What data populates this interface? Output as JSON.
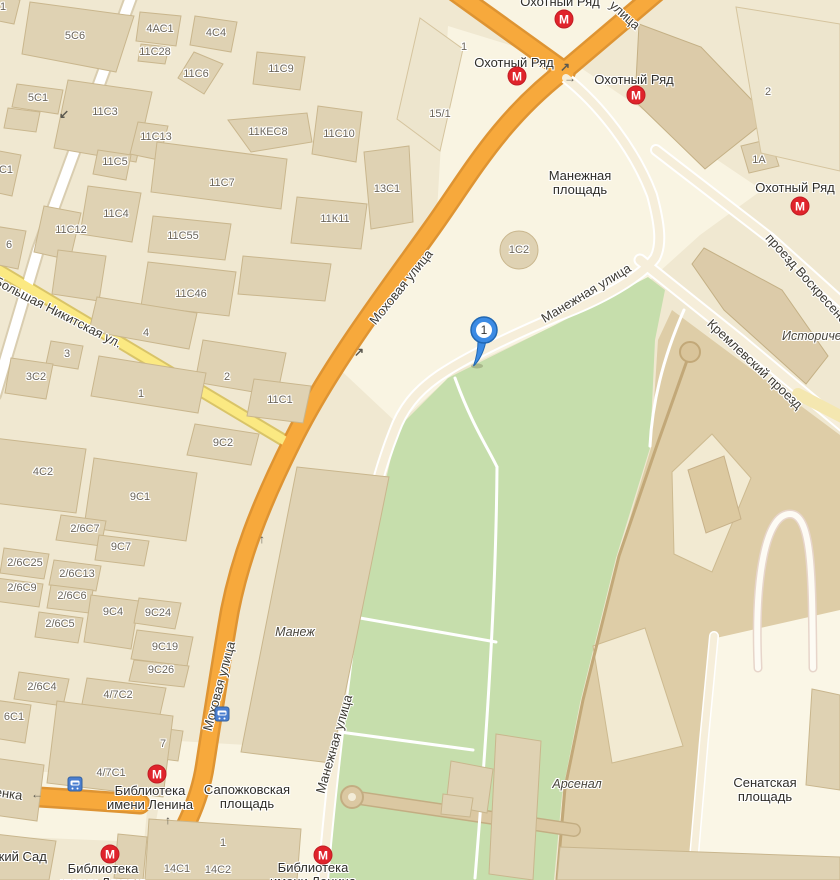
{
  "map": {
    "marker": {
      "label": "1"
    },
    "metro_letter": "М",
    "building_labels": [
      {
        "t": "1",
        "x": 3,
        "y": 7
      },
      {
        "t": "5С6",
        "x": 75,
        "y": 36
      },
      {
        "t": "4АС1",
        "x": 160,
        "y": 29
      },
      {
        "t": "4С4",
        "x": 216,
        "y": 33
      },
      {
        "t": "11С28",
        "x": 155,
        "y": 52
      },
      {
        "t": "11С6",
        "x": 196,
        "y": 74
      },
      {
        "t": "11С9",
        "x": 281,
        "y": 69
      },
      {
        "t": "5С1",
        "x": 38,
        "y": 98
      },
      {
        "t": "11С3",
        "x": 105,
        "y": 112
      },
      {
        "t": "11С13",
        "x": 156,
        "y": 137
      },
      {
        "t": "11КЕС8",
        "x": 268,
        "y": 132
      },
      {
        "t": "11С10",
        "x": 339,
        "y": 134
      },
      {
        "t": "11С5",
        "x": 115,
        "y": 162
      },
      {
        "t": "11С7",
        "x": 222,
        "y": 183
      },
      {
        "t": "13С1",
        "x": 387,
        "y": 189
      },
      {
        "t": "11С4",
        "x": 116,
        "y": 214
      },
      {
        "t": "11К11",
        "x": 335,
        "y": 219
      },
      {
        "t": "11С12",
        "x": 71,
        "y": 230
      },
      {
        "t": "11С55",
        "x": 183,
        "y": 236
      },
      {
        "t": "С1",
        "x": 6,
        "y": 170
      },
      {
        "t": "6",
        "x": 9,
        "y": 245
      },
      {
        "t": "11С46",
        "x": 191,
        "y": 294
      },
      {
        "t": "4",
        "x": 146,
        "y": 333
      },
      {
        "t": "1",
        "x": 464,
        "y": 47
      },
      {
        "t": "15/1",
        "x": 440,
        "y": 114
      },
      {
        "t": "1С2",
        "x": 519,
        "y": 250
      },
      {
        "t": "3",
        "x": 67,
        "y": 354
      },
      {
        "t": "3С2",
        "x": 36,
        "y": 377
      },
      {
        "t": "2",
        "x": 227,
        "y": 377
      },
      {
        "t": "1",
        "x": 141,
        "y": 394
      },
      {
        "t": "11С1",
        "x": 280,
        "y": 400
      },
      {
        "t": "9С2",
        "x": 223,
        "y": 443
      },
      {
        "t": "2",
        "x": 768,
        "y": 92
      },
      {
        "t": "1А",
        "x": 759,
        "y": 160
      },
      {
        "t": "4С2",
        "x": 43,
        "y": 472
      },
      {
        "t": "9С1",
        "x": 140,
        "y": 497
      },
      {
        "t": "2/6С7",
        "x": 85,
        "y": 529
      },
      {
        "t": "9С7",
        "x": 121,
        "y": 547
      },
      {
        "t": "2/6С25",
        "x": 25,
        "y": 563
      },
      {
        "t": "2/6С13",
        "x": 77,
        "y": 574
      },
      {
        "t": "2/6С9",
        "x": 22,
        "y": 588
      },
      {
        "t": "2/6С6",
        "x": 72,
        "y": 596
      },
      {
        "t": "9С4",
        "x": 113,
        "y": 612
      },
      {
        "t": "9С24",
        "x": 158,
        "y": 613
      },
      {
        "t": "2/6С5",
        "x": 60,
        "y": 624
      },
      {
        "t": "9С19",
        "x": 165,
        "y": 647
      },
      {
        "t": "9С26",
        "x": 161,
        "y": 670
      },
      {
        "t": "2/6С4",
        "x": 42,
        "y": 687
      },
      {
        "t": "4/7С2",
        "x": 118,
        "y": 695
      },
      {
        "t": "6С1",
        "x": 14,
        "y": 717
      },
      {
        "t": "7",
        "x": 163,
        "y": 744
      },
      {
        "t": "4/7С1",
        "x": 111,
        "y": 773
      },
      {
        "t": "1",
        "x": 223,
        "y": 843
      },
      {
        "t": "14С1",
        "x": 177,
        "y": 869
      },
      {
        "t": "14С2",
        "x": 218,
        "y": 870
      }
    ],
    "street_labels": [
      {
        "t": "Моховая улица",
        "x": 401,
        "y": 287,
        "r": -51
      },
      {
        "t": "Моховая улица",
        "x": 219,
        "y": 686,
        "r": -75
      },
      {
        "t": "Манежная улица",
        "x": 586,
        "y": 293,
        "r": -31
      },
      {
        "t": "Манежная улица",
        "x": 334,
        "y": 744,
        "r": -74
      },
      {
        "t": "Большая Никитская ул.",
        "x": 58,
        "y": 312,
        "r": 27
      },
      {
        "t": "проезд Воскресенские Ворота",
        "x": 829,
        "y": 303,
        "r": 48
      },
      {
        "t": "Кремлевский проезд",
        "x": 755,
        "y": 364,
        "r": 43
      },
      {
        "t": "улица",
        "x": 625,
        "y": 15,
        "r": 42
      },
      {
        "t": "Воздвиженка",
        "x": -17,
        "y": 790,
        "r": 8
      }
    ],
    "place_labels": [
      {
        "lines": [
          "Охотный Ряд"
        ],
        "x": 560,
        "y": 2
      },
      {
        "lines": [
          "Охотный Ряд"
        ],
        "x": 514,
        "y": 63
      },
      {
        "lines": [
          "Охотный Ряд"
        ],
        "x": 634,
        "y": 80
      },
      {
        "lines": [
          "Охотный Ряд"
        ],
        "x": 795,
        "y": 188
      },
      {
        "lines": [
          "Манежная",
          "площадь"
        ],
        "x": 580,
        "y": 183
      },
      {
        "lines": [
          "Сапожковская",
          "площадь"
        ],
        "x": 247,
        "y": 797
      },
      {
        "lines": [
          "Библиотека",
          "имени Ленина"
        ],
        "x": 150,
        "y": 798
      },
      {
        "lines": [
          "Библиотека",
          "имени Ленина"
        ],
        "x": 103,
        "y": 876
      },
      {
        "lines": [
          "Библиотека",
          "имени Ленина"
        ],
        "x": 313,
        "y": 875
      },
      {
        "lines": [
          "Сенатская",
          "площадь"
        ],
        "x": 765,
        "y": 790
      },
      {
        "lines": [
          "Александровский Сад"
        ],
        "x": -20,
        "y": 857
      }
    ],
    "landmark_labels": [
      {
        "t": "Манеж",
        "x": 295,
        "y": 632
      },
      {
        "t": "Арсенал",
        "x": 577,
        "y": 784
      },
      {
        "t": "Исторический музей",
        "x": 782,
        "y": 336,
        "a": "left"
      }
    ],
    "metro_icons": [
      {
        "x": 564,
        "y": 19
      },
      {
        "x": 517,
        "y": 76
      },
      {
        "x": 636,
        "y": 95
      },
      {
        "x": 800,
        "y": 206
      },
      {
        "x": 157,
        "y": 774
      },
      {
        "x": 110,
        "y": 854
      },
      {
        "x": 323,
        "y": 855
      }
    ],
    "bus_icons": [
      {
        "x": 75,
        "y": 784
      },
      {
        "x": 222,
        "y": 714
      }
    ],
    "arrows": [
      {
        "ch": "↙",
        "x": 64,
        "y": 114
      },
      {
        "ch": "↗",
        "x": 359,
        "y": 352
      },
      {
        "ch": "↑",
        "x": 262,
        "y": 539
      },
      {
        "ch": "↗",
        "x": 565,
        "y": 67
      },
      {
        "ch": "→",
        "x": 570,
        "y": 78
      },
      {
        "ch": "↑",
        "x": 168,
        "y": 820
      },
      {
        "ch": "←",
        "x": 37,
        "y": 794
      }
    ]
  }
}
